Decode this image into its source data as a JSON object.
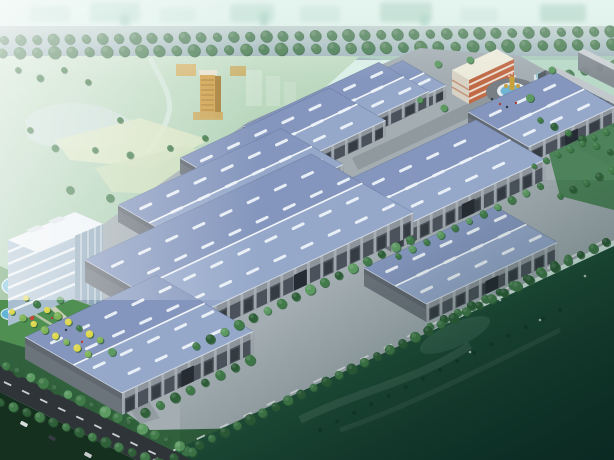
{
  "image_type": "aerial-architectural-rendering",
  "subject": "industrial-park-with-blue-roof-warehouses",
  "colors": {
    "sky_haze": "#d9efe7",
    "haze1": "#c0e0d6",
    "haze2": "#b2d8ca",
    "haze3": "#c8e4da",
    "haze4": "#a5cfbf",
    "highway1": "#bccfcb",
    "highway2": "#9db4bb",
    "park1": "#cfe4cf",
    "park2": "#9cc6a6",
    "right_haze": "#aed2bc",
    "field_light": "#dce6c6",
    "field_light2": "#cfdfbc",
    "lake": "#ccdfd8",
    "stream": "#d6e8de",
    "tower_body": "#d2a452",
    "tower_side": "#a8823c",
    "tower_cap": "#e8e2d0",
    "tower_stripe": "#8a6a30",
    "low_bldg1": "#d6b269",
    "low_bldg2": "#ccab60",
    "tree_dark": "#2e5f38",
    "tree_mid": "#417b49",
    "tree_light": "#5d9a62",
    "tree_row_back": "#4a7d54",
    "tree_row_back2": "#4f8156",
    "tree_yellow": "#ddd84e",
    "tree_lime": "#7fb35a",
    "pavement": "#a3adb2",
    "road_minor": "#8f999e",
    "road_dash": "#e8ecee",
    "roof_back": "#8496bd",
    "roof_front": "#95a8ca",
    "roof_ridge": "#f2f6fa",
    "roof_edge": "#5f6f94",
    "skylight": "#eef3f9",
    "eave": "#dfe6ef",
    "wall_upper": "#8d949b",
    "wall_lower": "#4b525b",
    "pilaster": "#a9b0b7",
    "wall_win": "#31383f",
    "wall_door": "#262c33",
    "wall_end": "#6b737b",
    "wall_end_dark": "#555c64",
    "lawn1": "#35744b",
    "lawn2": "#0f3229",
    "verge": "#2b5c36",
    "corner_dark": "#16301f",
    "bottom_road": "#2f3438",
    "garden_green": "#4f8f52",
    "pond": "#64b6d6",
    "path": "#d9d6c2",
    "flower_red": "#c04838",
    "office_white": "#eef3f6",
    "office_glass": "#a9bfd0",
    "office_glass2": "#8fa8ba",
    "office_box": "#dde4e8",
    "admin_roof": "#eceada",
    "admin_red": "#c06a46",
    "admin_end": "#d8d2c4",
    "plaza_ground": "#787f85",
    "plaza_rim": "#e8eef0",
    "plaza_water": "#6fb6d4",
    "statue_gold": "#c9a03e",
    "gate_white": "#dfe7ea",
    "gate_teal": "#8fc8cc",
    "dorm_face": "#6f767e",
    "dorm_face2": "#828990",
    "dorm_end": "#575e66",
    "dorm_roof": "#c3c8cd",
    "dorm_roof2": "#cdd2d6",
    "dorm_win": "#3c434b",
    "dorm_line": "#9aa2a8",
    "green_strip": "#3f7a4a",
    "car_light": "#d8dde0",
    "car_dark": "#343b42",
    "car_grey": "#c8ccd0",
    "speck_white": "#e8f0ec",
    "people_red": "#b04030",
    "people_dark": "#303840",
    "ghost_path": "#cfe0d8",
    "ghost_lake": "#a8cabe",
    "ghost_bldg": "#ffffff"
  },
  "scene": {
    "axes": {
      "a": [
        0.905,
        -0.425
      ],
      "b": [
        0.866,
        0.5
      ]
    },
    "warehouses": [
      {
        "name": "warehouse-9-top-center",
        "x": 312,
        "y": 103,
        "l": 100,
        "w": 50,
        "h": 13
      },
      {
        "name": "warehouse-8-upper",
        "x": 243,
        "y": 126,
        "l": 150,
        "w": 58,
        "h": 15
      },
      {
        "name": "warehouse-7-upper-left",
        "x": 180,
        "y": 158,
        "l": 165,
        "w": 65,
        "h": 16
      },
      {
        "name": "warehouse-6-top-right",
        "x": 468,
        "y": 112,
        "l": 95,
        "w": 70,
        "h": 16
      },
      {
        "name": "warehouse-5-mid-left",
        "x": 118,
        "y": 205,
        "l": 180,
        "w": 72,
        "h": 17
      },
      {
        "name": "warehouse-4-center-right",
        "x": 322,
        "y": 192,
        "l": 170,
        "w": 80,
        "h": 20
      },
      {
        "name": "warehouse-2-central-big",
        "x": 85,
        "y": 260,
        "l": 250,
        "w": 118,
        "h": 22
      },
      {
        "name": "warehouse-3-front-right",
        "x": 364,
        "y": 268,
        "l": 145,
        "w": 72,
        "h": 18
      },
      {
        "name": "warehouse-1-front-left",
        "x": 25,
        "y": 337,
        "l": 145,
        "w": 112,
        "h": 22
      }
    ],
    "back_tree_lines": [
      {
        "f": [
          4,
          40
        ],
        "t": [
          610,
          31
        ],
        "s": 16,
        "r": 5,
        "c": [
          "tree_row_back"
        ],
        "o": 0.95
      },
      {
        "f": [
          2,
          53
        ],
        "t": [
          612,
          44
        ],
        "s": 17,
        "r": 5.5,
        "c": [
          "tree_row_back2",
          "tree_row_back"
        ],
        "o": 1
      },
      {
        "f": [
          100,
          258
        ],
        "t": [
          292,
          168
        ],
        "s": 17,
        "r": 3,
        "c": [
          "tree_mid"
        ],
        "o": 1
      },
      {
        "f": [
          524,
          84
        ],
        "t": [
          614,
          64
        ],
        "s": 14,
        "r": 4,
        "c": [
          "tree_row_back"
        ],
        "o": 0.9
      }
    ],
    "front_tree_lines": [
      {
        "f": [
          196,
          346
        ],
        "t": [
          410,
          240
        ],
        "s": 15,
        "r": 4.5,
        "c": [
          "tree_mid",
          "tree_dark",
          "tree_light"
        ],
        "o": 1
      },
      {
        "f": [
          130,
          420
        ],
        "t": [
          250,
          360
        ],
        "s": 15,
        "r": 4.5,
        "c": [
          "tree_mid",
          "tree_dark"
        ],
        "o": 1
      },
      {
        "f": [
          430,
          326
        ],
        "t": [
          568,
          258
        ],
        "s": 14,
        "r": 4,
        "c": [
          "tree_mid",
          "tree_dark"
        ],
        "o": 1
      },
      {
        "f": [
          398,
          256
        ],
        "t": [
          540,
          186
        ],
        "s": 15,
        "r": 3.5,
        "c": [
          "tree_mid",
          "tree_light"
        ],
        "o": 1
      },
      {
        "f": [
          148,
          470
        ],
        "t": [
          606,
          242
        ],
        "s": 14,
        "r": 4.5,
        "c": [
          "tree_dark",
          "tree_mid"
        ],
        "o": 1
      },
      {
        "f": [
          6,
          366
        ],
        "t": [
          192,
          452
        ],
        "s": 13,
        "r": 5,
        "c": [
          "tree_mid",
          "tree_dark",
          "tree_light"
        ],
        "o": 1
      },
      {
        "f": [
          0,
          402
        ],
        "t": [
          158,
          462
        ],
        "s": 14,
        "r": 4.5,
        "c": [
          "tree_dark",
          "tree_mid"
        ],
        "o": 1
      },
      {
        "f": [
          26,
          298
        ],
        "t": [
          100,
          340
        ],
        "s": 11,
        "r": 3.5,
        "c": [
          "tree_yellow",
          "tree_mid",
          "tree_yellow",
          "tree_lime"
        ],
        "o": 1
      },
      {
        "f": [
          12,
          312
        ],
        "t": [
          88,
          354
        ],
        "s": 12,
        "r": 3.5,
        "c": [
          "tree_yellow",
          "tree_lime"
        ],
        "o": 1
      },
      {
        "f": [
          540,
          120
        ],
        "t": [
          610,
          152
        ],
        "s": 13,
        "r": 3.5,
        "c": [
          "tree_mid",
          "tree_dark"
        ],
        "o": 1
      },
      {
        "f": [
          560,
          196
        ],
        "t": [
          612,
          170
        ],
        "s": 13,
        "r": 3.5,
        "c": [
          "tree_mid",
          "tree_dark"
        ],
        "o": 1
      },
      {
        "f": [
          534,
          166
        ],
        "t": [
          606,
          132
        ],
        "s": 13,
        "r": 3,
        "c": [
          "tree_mid"
        ],
        "o": 1
      }
    ],
    "park_trees": [
      [
        18,
        70,
        3
      ],
      [
        40,
        78,
        3.5
      ],
      [
        64,
        70,
        3
      ],
      [
        88,
        82,
        3
      ],
      [
        30,
        130,
        3
      ],
      [
        55,
        148,
        3.5
      ],
      [
        95,
        150,
        3
      ],
      [
        130,
        155,
        3.5
      ],
      [
        170,
        148,
        3
      ],
      [
        205,
        138,
        3
      ],
      [
        70,
        190,
        4
      ],
      [
        110,
        198,
        4
      ],
      [
        150,
        205,
        3.5
      ],
      [
        195,
        195,
        3.5
      ],
      [
        235,
        185,
        3.5
      ],
      [
        270,
        170,
        3
      ],
      [
        155,
        225,
        4
      ],
      [
        200,
        222,
        4
      ],
      [
        250,
        212,
        4
      ],
      [
        300,
        150,
        3
      ],
      [
        315,
        125,
        3
      ],
      [
        335,
        100,
        3
      ],
      [
        120,
        120,
        3
      ],
      [
        250,
        145,
        3
      ]
    ],
    "deco_trees": [
      [
        530,
        98,
        4
      ],
      [
        552,
        70,
        3.5
      ],
      [
        470,
        60,
        3.5
      ],
      [
        438,
        64,
        3.5
      ],
      [
        420,
        100,
        3
      ],
      [
        444,
        108,
        3.5
      ],
      [
        112,
        352,
        4
      ],
      [
        60,
        300,
        3.5
      ]
    ],
    "haze_blobs": [
      [
        30,
        6,
        40,
        16,
        "haze1",
        0.8
      ],
      [
        90,
        2,
        50,
        20,
        "haze2",
        0.7
      ],
      [
        160,
        8,
        36,
        14,
        "haze3",
        0.8
      ],
      [
        230,
        4,
        44,
        18,
        "haze2",
        0.7
      ],
      [
        300,
        6,
        40,
        16,
        "haze1",
        0.75
      ],
      [
        380,
        2,
        52,
        20,
        "haze4",
        0.7
      ],
      [
        460,
        8,
        38,
        14,
        "haze3",
        0.8
      ],
      [
        540,
        4,
        46,
        18,
        "haze4",
        0.75
      ],
      [
        120,
        14,
        10,
        12,
        "haze4",
        0.9
      ],
      [
        260,
        12,
        8,
        14,
        "haze4",
        0.85
      ],
      [
        420,
        14,
        9,
        12,
        "haze4",
        0.85
      ]
    ],
    "road_dashes": [
      {
        "f": [
          150,
          462
        ],
        "t": [
          606,
          240
        ],
        "s": 26,
        "len": 9,
        "w": 1.8
      },
      {
        "f": [
          4,
          382
        ],
        "t": [
          172,
          462
        ],
        "s": 20,
        "len": 8,
        "w": 1.8
      },
      {
        "f": [
          516,
          100
        ],
        "t": [
          606,
          152
        ],
        "s": 22,
        "len": 7,
        "w": 1.5
      }
    ],
    "cars": [
      {
        "x": 24,
        "y": 424,
        "c": "car_light",
        "ang": 27
      },
      {
        "x": 52,
        "y": 438,
        "c": "car_dark",
        "ang": 27
      },
      {
        "x": 88,
        "y": 455,
        "c": "car_grey",
        "ang": 27
      }
    ],
    "lawn_specks": [
      [
        500,
        300
      ],
      [
        540,
        320
      ],
      [
        470,
        352
      ],
      [
        560,
        268
      ],
      [
        585,
        276
      ]
    ],
    "people": [
      [
        500,
        104,
        "people_red"
      ],
      [
        507,
        107,
        "people_dark"
      ],
      [
        516,
        103,
        "people_red"
      ],
      [
        492,
        99,
        "people_dark"
      ],
      [
        52,
        318,
        "people_red"
      ],
      [
        66,
        330,
        "people_dark"
      ],
      [
        82,
        342,
        "people_red"
      ]
    ],
    "lawn_dot_line": {
      "f": [
        320,
        430
      ],
      "t": [
        560,
        310
      ],
      "s": 18
    }
  }
}
